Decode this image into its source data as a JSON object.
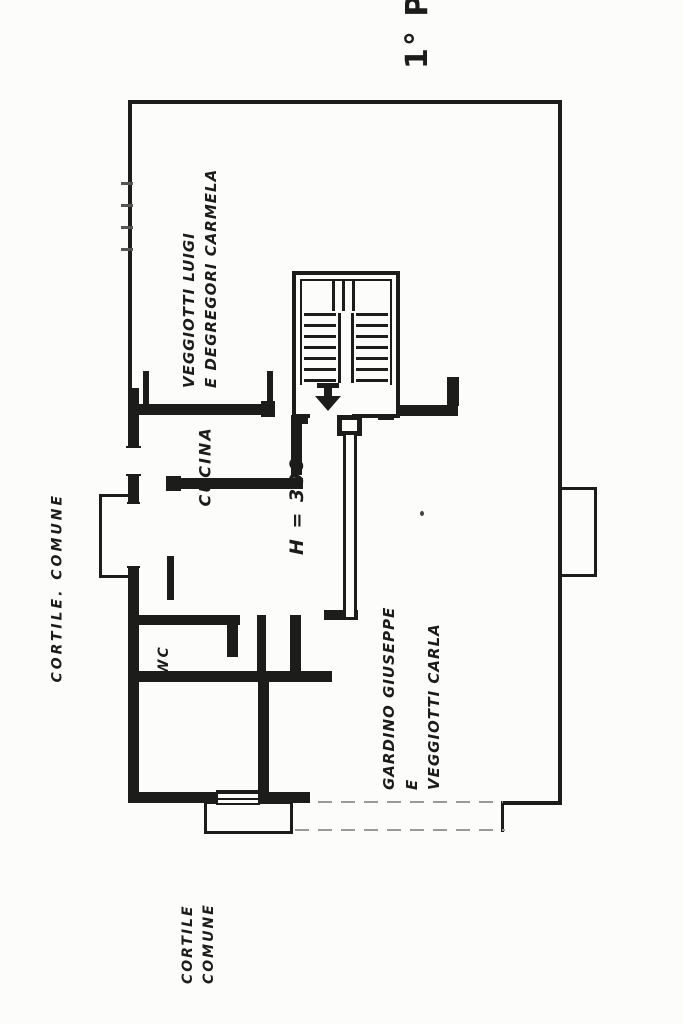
{
  "plan": {
    "floor_label": "1° P",
    "units": {
      "top": {
        "line1": "VEGGIOTTI LUIGI",
        "line2": "E DEGREGORI CARMELA"
      },
      "bottom": {
        "line1": "GARDINO GIUSEPPE",
        "line2": "E",
        "line3": "VEGGIOTTI CARLA"
      }
    },
    "rooms": {
      "kitchen": "CUCINA",
      "wc": "WC"
    },
    "annotations": {
      "ceiling_height": "H = 300"
    },
    "exterior": {
      "courtyard_left": "CORTILE. COMUNE",
      "courtyard_bottom": {
        "line1": "CORTILE",
        "line2": "COMUNE"
      }
    }
  },
  "colors": {
    "ink": "#1c1c1a",
    "paper": "#fcfcfa",
    "faint": "#9a9a96"
  }
}
